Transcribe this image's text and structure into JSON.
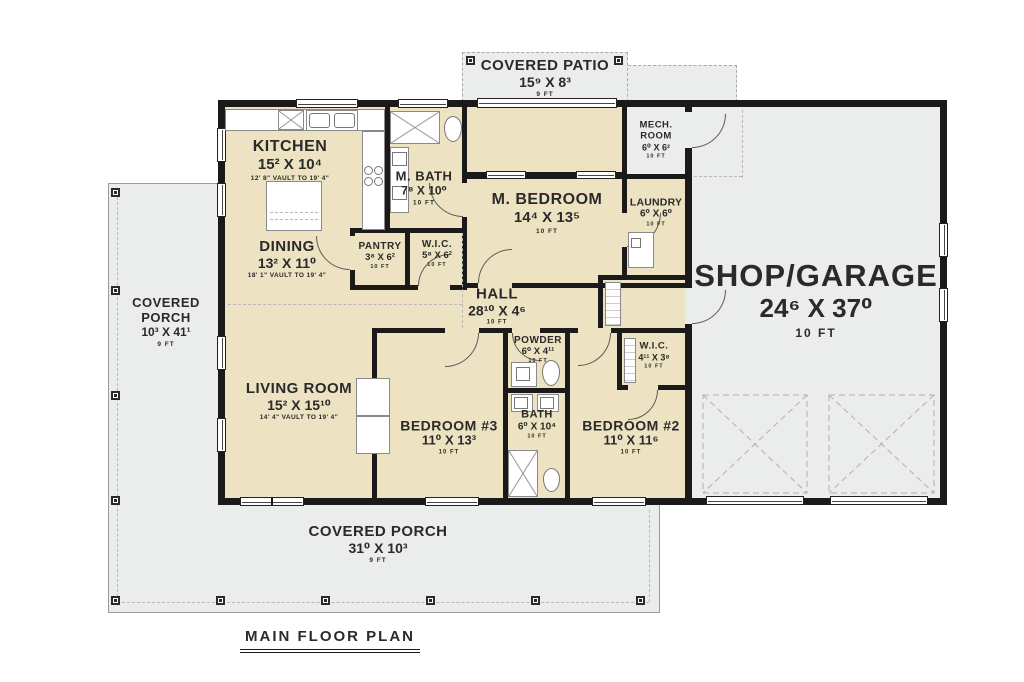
{
  "title": "MAIN FLOOR PLAN",
  "colors": {
    "interior_floor": "#ede3c2",
    "porch_garage_floor": "#ebecec",
    "wall": "#1a1a1a",
    "text": "#2a2a2a"
  },
  "rooms": {
    "covered_patio": {
      "name": "COVERED PATIO",
      "dims": "15⁹ X 8³",
      "note": "9 FT"
    },
    "mech_room": {
      "name": "MECH. ROOM",
      "dims": "6⁰ X 6²",
      "note": "10 FT"
    },
    "kitchen": {
      "name": "KITCHEN",
      "dims": "15² X 10⁴",
      "note": "12' 8\" VAULT TO 19' 4\""
    },
    "m_bath": {
      "name": "M. BATH",
      "dims": "7⁸ X 10⁰",
      "note": "10 FT"
    },
    "m_bedroom": {
      "name": "M. BEDROOM",
      "dims": "14⁴ X 13⁵",
      "note": "10 FT"
    },
    "laundry": {
      "name": "LAUNDRY",
      "dims": "6⁰ X 6⁰",
      "note": "10 FT"
    },
    "dining": {
      "name": "DINING",
      "dims": "13² X 11⁰",
      "note": "18' 1\" VAULT TO 19' 4\""
    },
    "pantry": {
      "name": "PANTRY",
      "dims": "3⁸ X 6²",
      "note": "10 FT"
    },
    "wic_master": {
      "name": "W.I.C.",
      "dims": "5⁸ X 6²",
      "note": "10 FT"
    },
    "hall": {
      "name": "HALL",
      "dims": "28¹⁰ X 4⁶",
      "note": "10 FT"
    },
    "powder": {
      "name": "POWDER",
      "dims": "6⁰ X 4¹¹",
      "note": "10 FT"
    },
    "living_room": {
      "name": "LIVING ROOM",
      "dims": "15² X 15¹⁰",
      "note": "14' 4\" VAULT TO 19' 4\""
    },
    "bedroom_3": {
      "name": "BEDROOM #3",
      "dims": "11⁰ X 13³",
      "note": "10 FT"
    },
    "bath": {
      "name": "BATH",
      "dims": "6⁰ X 10⁴",
      "note": "10 FT"
    },
    "bedroom_2": {
      "name": "BEDROOM #2",
      "dims": "11⁰ X 11⁶",
      "note": "10 FT"
    },
    "wic_2": {
      "name": "W.I.C.",
      "dims": "4¹¹ X 3⁸",
      "note": "10 FT"
    },
    "shop_garage": {
      "name": "SHOP/GARAGE",
      "dims": "24⁶ X 37⁰",
      "note": "10 FT"
    },
    "covered_porch_left": {
      "name": "COVERED PORCH",
      "dims": "10³ X 41¹",
      "note": "9 FT"
    },
    "covered_porch_bottom": {
      "name": "COVERED PORCH",
      "dims": "31⁰ X 10³",
      "note": "9 FT"
    }
  }
}
